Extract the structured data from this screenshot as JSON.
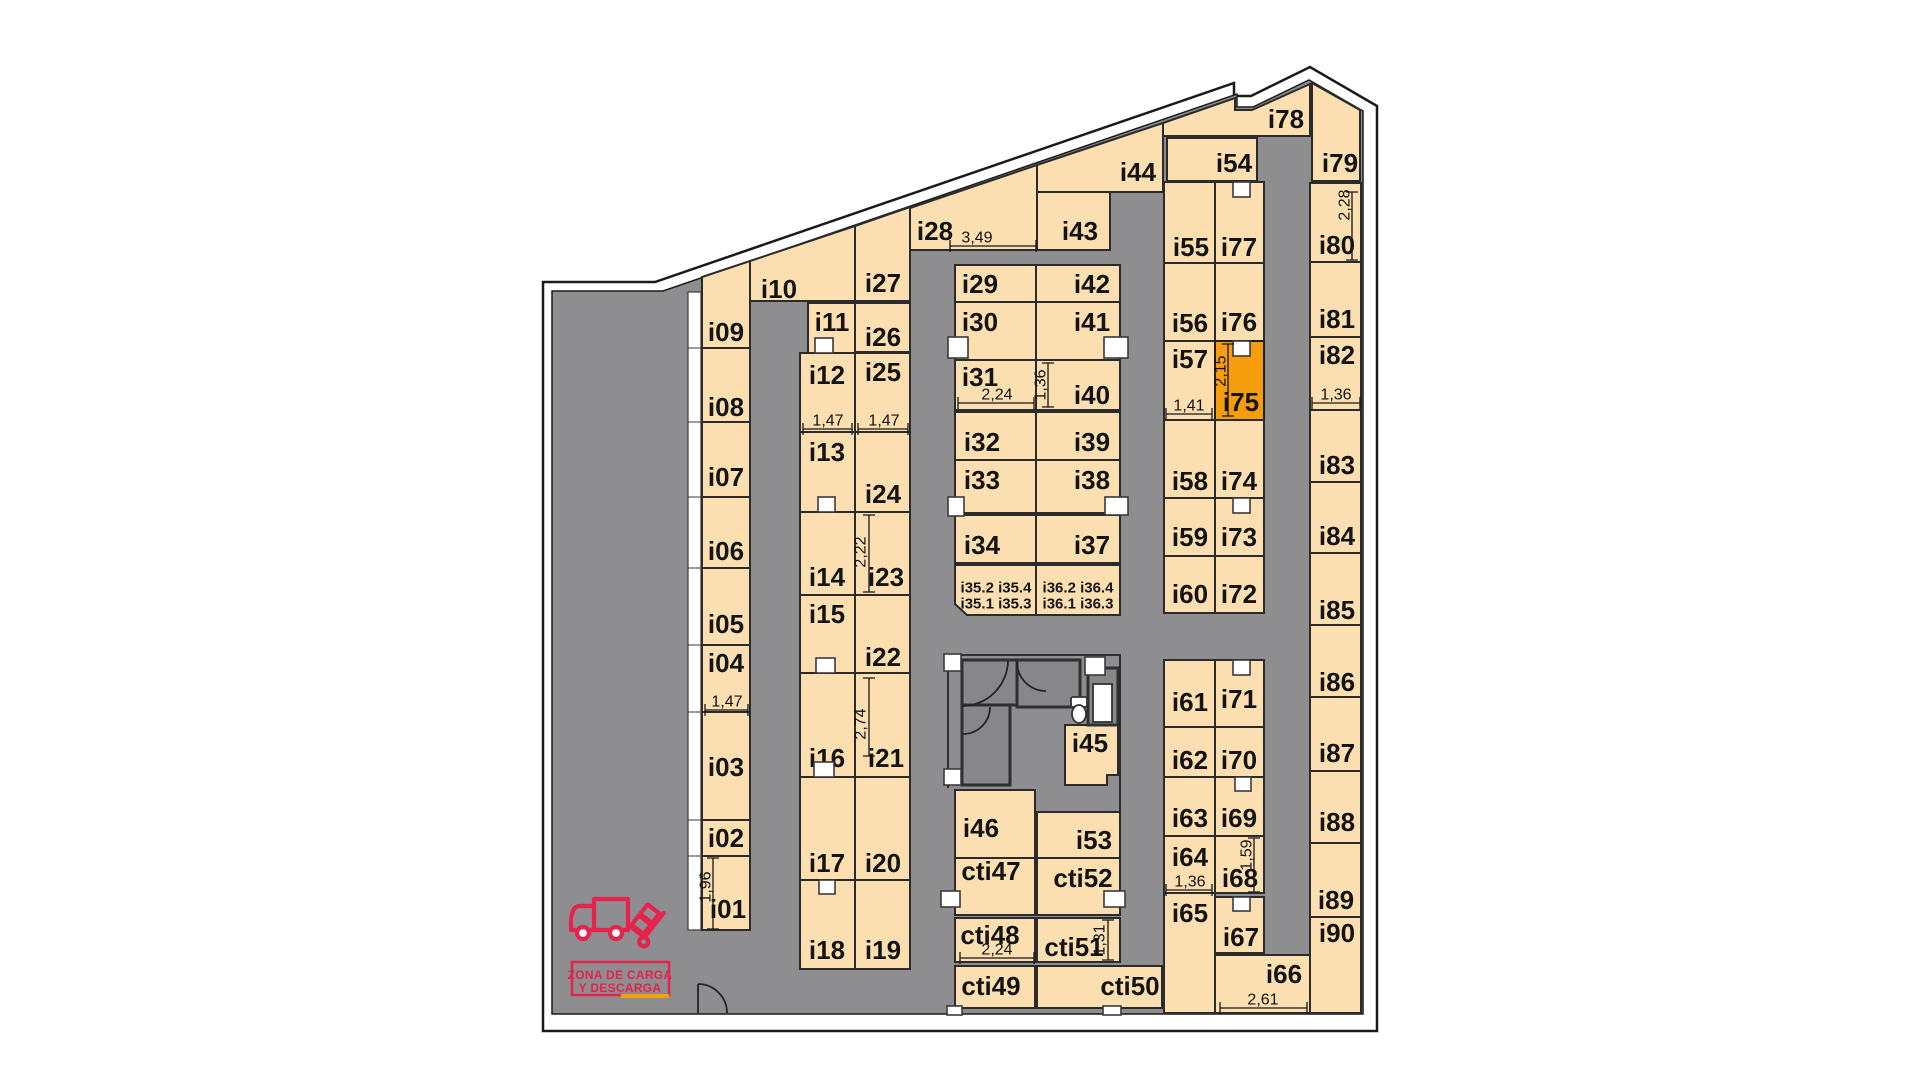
{
  "selected_unit": "i75",
  "colors": {
    "room": "#FBDFB0",
    "corridor": "#8E8E90",
    "highlight": "#F59D0C",
    "red": "#E5234D",
    "yellow": "#F0A30A"
  },
  "units": {
    "i01": "i01",
    "i02": "i02",
    "i03": "i03",
    "i04": "i04",
    "i05": "i05",
    "i06": "i06",
    "i07": "i07",
    "i08": "i08",
    "i09": "i09",
    "i10": "i10",
    "i11": "i11",
    "i12": "i12",
    "i13": "i13",
    "i14": "i14",
    "i15": "i15",
    "i16": "i16",
    "i17": "i17",
    "i18": "i18",
    "i19": "i19",
    "i20": "i20",
    "i21": "i21",
    "i22": "i22",
    "i23": "i23",
    "i24": "i24",
    "i25": "i25",
    "i26": "i26",
    "i27": "i27",
    "i28": "i28",
    "i29": "i29",
    "i30": "i30",
    "i31": "i31",
    "i32": "i32",
    "i33": "i33",
    "i34": "i34",
    "i35a": "i35.2  i35.4",
    "i35b": "i35.1  i35.3",
    "i36a": "i36.2  i36.4",
    "i36b": "i36.1  i36.3",
    "i37": "i37",
    "i38": "i38",
    "i39": "i39",
    "i40": "i40",
    "i41": "i41",
    "i42": "i42",
    "i43": "i43",
    "i44": "i44",
    "i45": "i45",
    "i46": "i46",
    "cti47": "cti47",
    "cti48": "cti48",
    "cti49": "cti49",
    "cti50": "cti50",
    "cti51": "cti51",
    "cti52": "cti52",
    "i53": "i53",
    "i54": "i54",
    "i55": "i55",
    "i56": "i56",
    "i57": "i57",
    "i58": "i58",
    "i59": "i59",
    "i60": "i60",
    "i61": "i61",
    "i62": "i62",
    "i63": "i63",
    "i64": "i64",
    "i65": "i65",
    "i66": "i66",
    "i67": "i67",
    "i68": "i68",
    "i69": "i69",
    "i70": "i70",
    "i71": "i71",
    "i72": "i72",
    "i73": "i73",
    "i74": "i74",
    "i75": "i75",
    "i76": "i76",
    "i77": "i77",
    "i78": "i78",
    "i79": "i79",
    "i80": "i80",
    "i81": "i81",
    "i82": "i82",
    "i83": "i83",
    "i84": "i84",
    "i85": "i85",
    "i86": "i86",
    "i87": "i87",
    "i88": "i88",
    "i89": "i89",
    "i90": "i90"
  },
  "dims": {
    "d349": "3,49",
    "d224a": "2,24",
    "d136a": "1,36",
    "d147a": "1,47",
    "d147b": "1,47",
    "d147c": "1,47",
    "d222": "2,22",
    "d274": "2,74",
    "d196": "1,96",
    "d224b": "2,24",
    "d131": "1,31",
    "d261": "2,61",
    "d136b": "1,36",
    "d159": "1,59",
    "d141": "1,41",
    "d215": "2,15",
    "d228": "2,28",
    "d136c": "1,36"
  },
  "loading_zone": {
    "line1": "ZONA DE CARGA",
    "line2": "Y DESCARGA"
  }
}
